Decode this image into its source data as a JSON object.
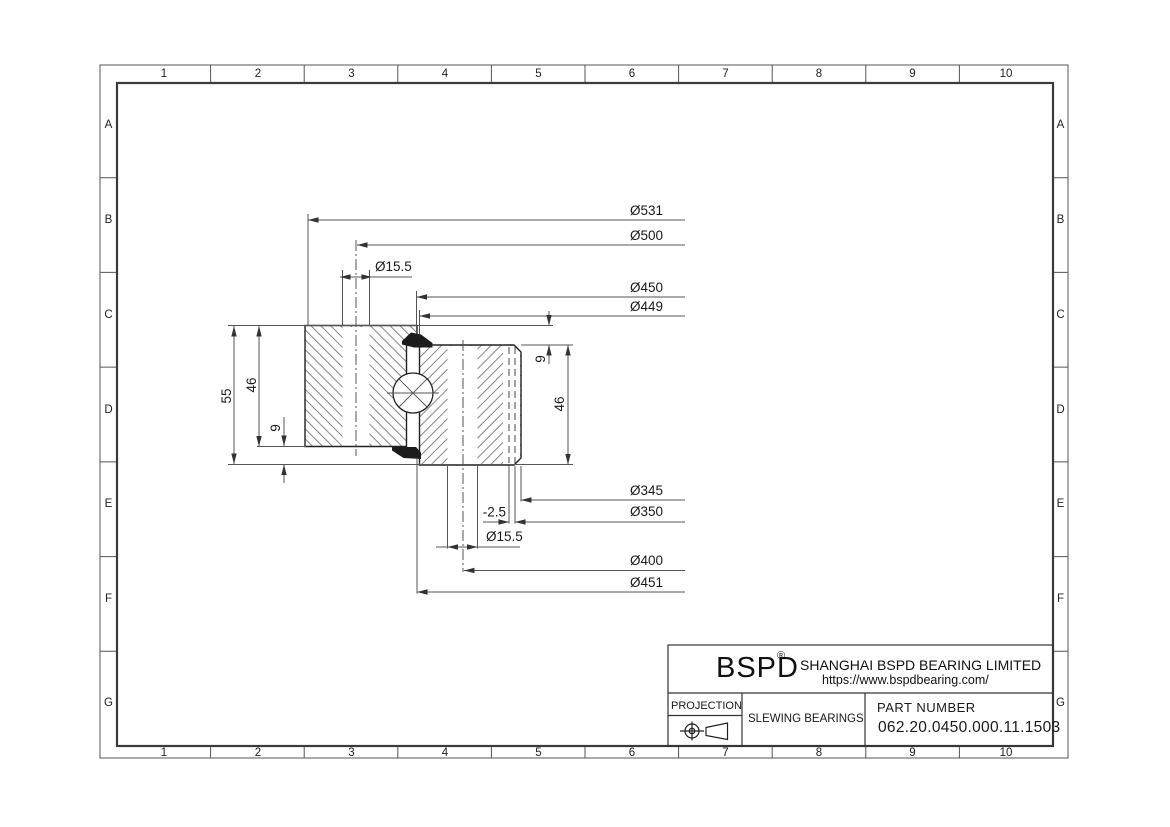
{
  "grid": {
    "cols": [
      "1",
      "2",
      "3",
      "4",
      "5",
      "6",
      "7",
      "8",
      "9",
      "10"
    ],
    "rows": [
      "A",
      "B",
      "C",
      "D",
      "E",
      "F",
      "G"
    ]
  },
  "drawing": {
    "dims": {
      "outer_diameter": "Ø531",
      "outer_bolt_circle": "Ø500",
      "outer_hole_diameter": "Ø15.5",
      "raceway_outer": "Ø450",
      "raceway_recess": "Ø449",
      "gear_tip_diameter": "Ø345",
      "bore_diameter": "Ø350",
      "tooth_offset": "-2.5",
      "inner_hole_diameter": "Ø15.5",
      "inner_bolt_circle": "Ø400",
      "inner_ring_outer": "Ø451",
      "total_height": "55",
      "outer_ring_height": "46",
      "bottom_offset": "9",
      "top_offset": "9",
      "inner_ring_height": "46"
    }
  },
  "title_block": {
    "logo": "BSPD",
    "registered": "®",
    "company": "SHANGHAI BSPD BEARING LIMITED",
    "website": "https://www.bspdbearing.com/",
    "projection_label": "PROJECTION",
    "product_type": "SLEWING BEARINGS",
    "part_number_label": "PART  NUMBER",
    "part_number": "062.20.0450.000.11.1503"
  },
  "colors": {
    "line": "#1a1a1a",
    "dim_line": "#555555",
    "hatch": "#777777",
    "background": "#ffffff"
  }
}
